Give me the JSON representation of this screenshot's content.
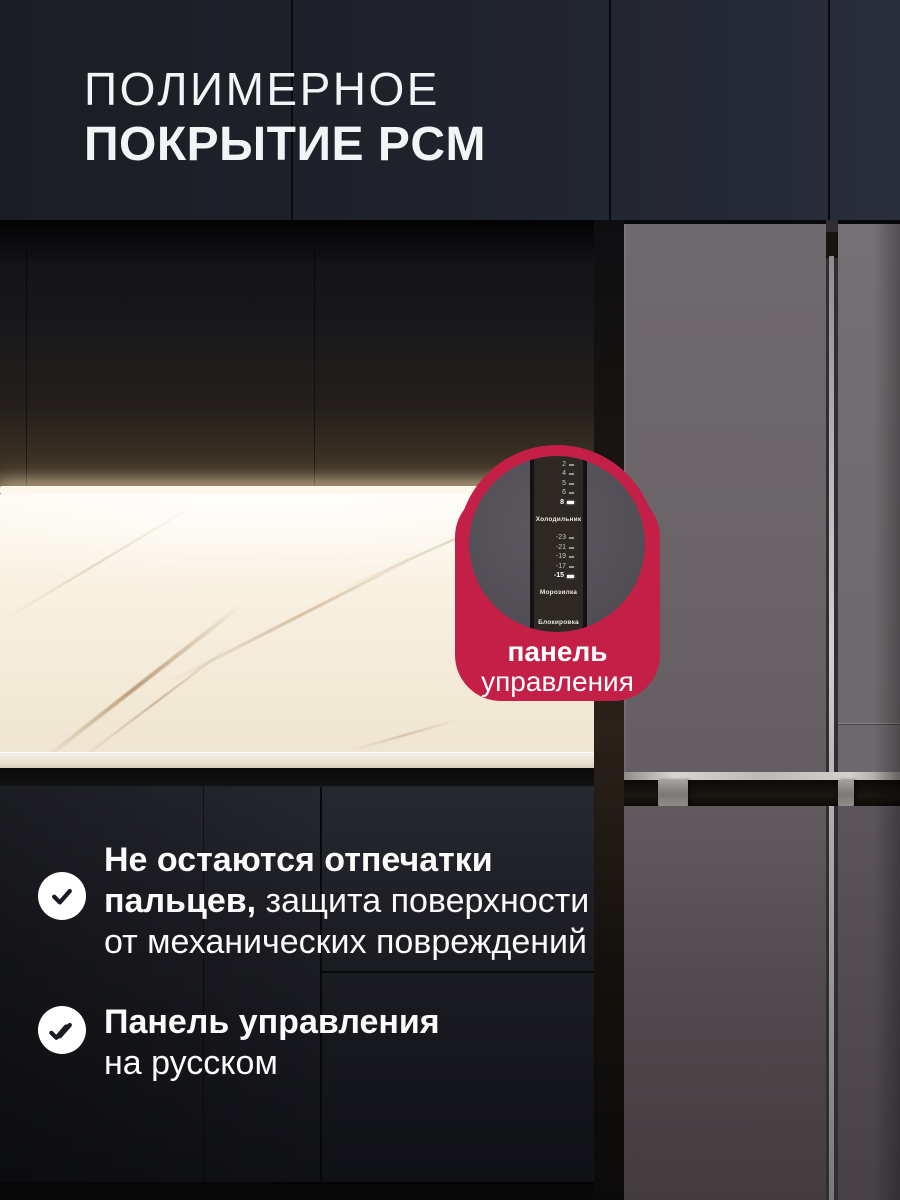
{
  "title": {
    "line1": "ПОЛИМЕРНОЕ",
    "line2": "ПОКРЫТИЕ PCM"
  },
  "callout": {
    "accent_color": "#c41f46",
    "label_line1": "панель",
    "label_line2": "управления",
    "panel_display": {
      "sections": [
        {
          "type": "temps",
          "values": [
            "2",
            "4",
            "5",
            "6",
            "8"
          ],
          "active": "8"
        },
        {
          "type": "label",
          "text": "Холодильник"
        },
        {
          "type": "temps",
          "values": [
            "-23",
            "-21",
            "-19",
            "-17",
            "-15"
          ],
          "active": "-15"
        },
        {
          "type": "label",
          "text": "Морозилка"
        },
        {
          "type": "label",
          "text": "Блокировка"
        }
      ]
    }
  },
  "features": [
    {
      "icon": "check",
      "lines": [
        {
          "bold": "Не остаются отпечатки",
          "regular": ""
        },
        {
          "bold": "пальцев,",
          "regular": "защита поверхности"
        },
        {
          "bold": "",
          "regular": "от механических повреждений"
        }
      ]
    },
    {
      "icon": "double-check",
      "lines": [
        {
          "bold": "Панель управления",
          "regular": ""
        },
        {
          "bold": "",
          "regular": "на русском"
        }
      ]
    }
  ]
}
